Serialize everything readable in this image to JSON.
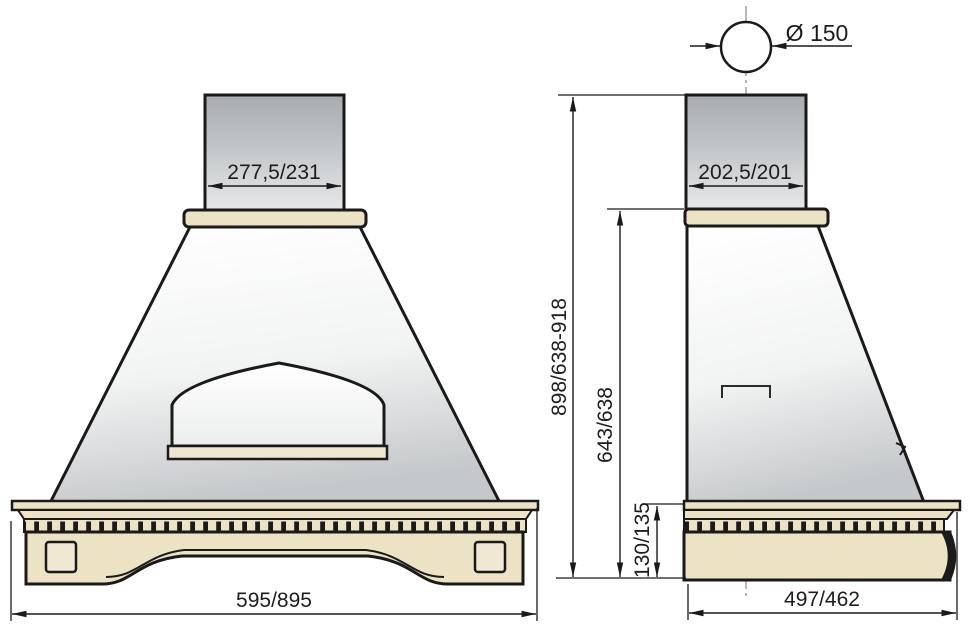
{
  "title": "Kitchen hood technical drawing",
  "dimensions": {
    "front_chimney_width": "277,5/231",
    "front_overall_width": "595/895",
    "side_duct_diameter": "Ø 150",
    "side_chimney_depth": "202,5/201",
    "side_overall_height": "898/638-918",
    "side_mid_height": "643/638",
    "side_base_height": "130/135",
    "side_overall_depth": "497/462"
  },
  "colors": {
    "wood_beige": "#ece2c4",
    "wood_light": "#f0e8d2",
    "outline": "#1a1a1a",
    "metal_gray_top": "#a7abae",
    "metal_gray_bottom": "#e8e9ea",
    "centerline_gray": "#9aa0a4"
  }
}
